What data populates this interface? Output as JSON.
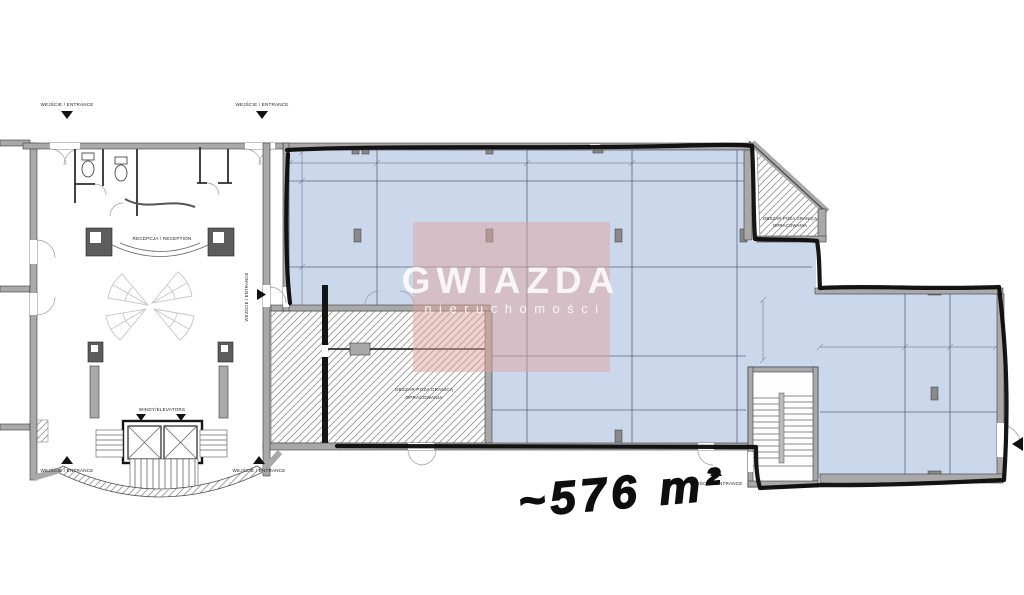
{
  "page": {
    "background": "#ffffff"
  },
  "watermark": {
    "brand": "GWIAZDA",
    "tagline": "nieruchomości",
    "overlay_color": "#dfa39d"
  },
  "annotation": {
    "area": "~576 m²"
  },
  "plan": {
    "labels": {
      "entrance": "WEJŚCIE / ENTRANCE",
      "reception": "RECEPCJA / RECEPTION",
      "elevators": "WINDY/ELEVATORS",
      "out_of_scope_line1": "OBSZAR POZA GRANICĄ",
      "out_of_scope_line2": "OPRACOWANIA"
    },
    "colors": {
      "unit_fill": "#cbd8ec",
      "wall_fill": "#a9a9a9",
      "grid_line": "#44526b",
      "marker": "#0a0a0a",
      "hatch_line": "#979797"
    }
  }
}
